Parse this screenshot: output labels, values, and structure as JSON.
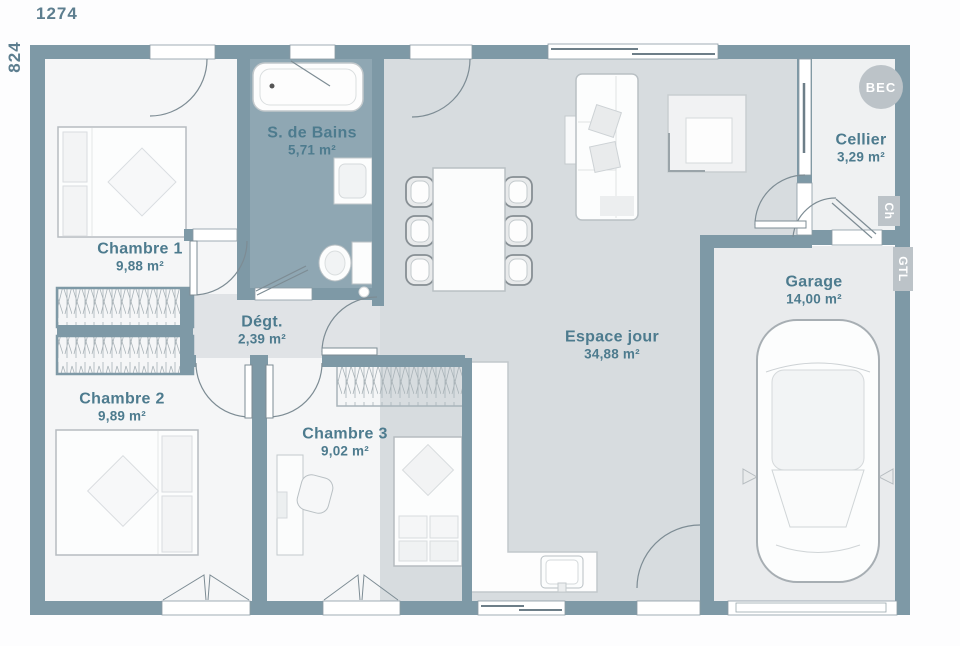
{
  "plan": {
    "dimensions": {
      "width": "1274",
      "height": "824"
    },
    "rooms": [
      {
        "name": "Chambre 1",
        "area": "9,88 m²"
      },
      {
        "name": "S. de Bains",
        "area": "5,71 m²"
      },
      {
        "name": "Dégt.",
        "area": "2,39 m²"
      },
      {
        "name": "Chambre 2",
        "area": "9,89 m²"
      },
      {
        "name": "Chambre 3",
        "area": "9,02 m²"
      },
      {
        "name": "Espace jour",
        "area": "34,88 m²"
      },
      {
        "name": "Cellier",
        "area": "3,29 m²"
      },
      {
        "name": "Garage",
        "area": "14,00 m²"
      }
    ],
    "badges": [
      {
        "label": "BEC"
      },
      {
        "label": "Ch"
      },
      {
        "label": "GTL"
      }
    ],
    "colors": {
      "wall": "#7E99A6",
      "bathroom_floor": "#8FA7B3",
      "living_floor": "#D7DCDF",
      "hall_floor": "#E0E3E6",
      "room_floor": "#F5F6F7",
      "cellier_floor": "#EFF1F2",
      "garage_floor": "#E9EBED",
      "label_text": "#4D7B8E",
      "dim_text": "#5D7E8F",
      "badge_bg": "#BCC3C8"
    }
  }
}
